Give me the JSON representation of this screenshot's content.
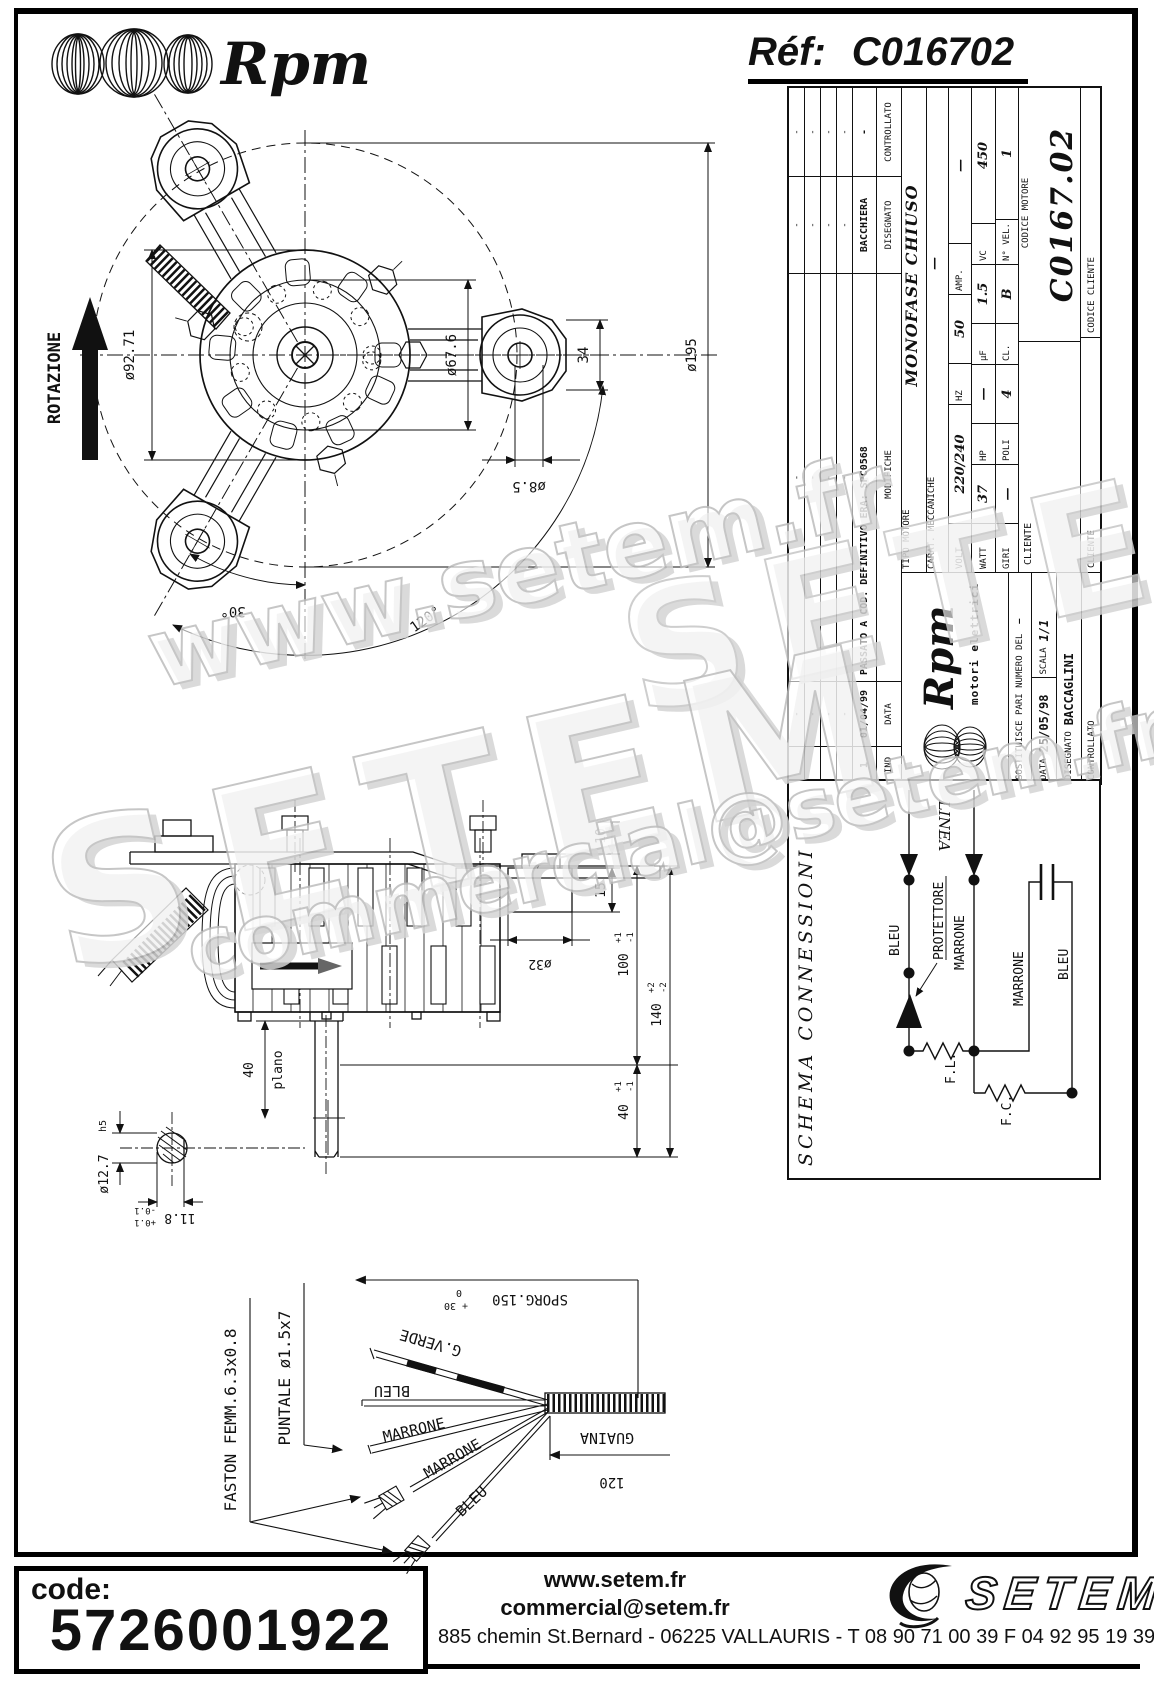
{
  "header": {
    "brand": "Rpm",
    "ref_label": "Réf:",
    "ref_value": "C016702"
  },
  "front_view": {
    "rotazione": "ROTAZIONE",
    "dia_core": "ø92.71",
    "dia_spigot": "ø67.6",
    "plate_width": "34",
    "dia_bolt_circle": "ø195",
    "dia_hole": "ø8.5",
    "angle_small": "30°",
    "angle_arms": "120°"
  },
  "side_view": {
    "d10": "10",
    "d15": "15",
    "d32": "ø32",
    "d100": "100",
    "d100_tp": "+1",
    "d100_tm": "-1",
    "d140": "140",
    "d140_tp": "+2",
    "d140_tm": "-2",
    "d40r": "40",
    "d40r_tp": "+1",
    "d40r_tm": "-1",
    "d40": "40",
    "plano": "plano",
    "d127": "ø12.7",
    "h5": "h5",
    "d118": "11.8",
    "d118_tp": "+0.1",
    "d118_tm": "-0.1"
  },
  "cable": {
    "faston": "FASTON FEMM.6.3x0.8",
    "puntale": "PUNTALE ø1.5x7",
    "sporg": "SPORG.150",
    "sporg_tp": "+ 30",
    "sporg_t0": "0",
    "guaina": "GUAINA",
    "d120": "120",
    "g_verde": "G.VERDE",
    "bleu1": "BLEU",
    "marrone1": "MARRONE",
    "marrone2": "MARRONE",
    "bleu2": "BLEU"
  },
  "schema": {
    "title": "SCHEMA CONNESSIONI",
    "linea": "LINEA",
    "bleu": "BLEU",
    "marrone": "MARRONE",
    "protettore": "PROTETTORE",
    "fl": "F.L.",
    "fc": "F.C.",
    "marrone2": "MARRONE",
    "bleu2": "BLEU"
  },
  "titleblock": {
    "dash": "-",
    "rev_header": {
      "ind": "IND",
      "data": "DATA",
      "modifiche": "MODIFICHE",
      "disegnato": "DISEGNATO",
      "controllato": "CONTROLLATO"
    },
    "rev_row": {
      "ind": "1",
      "data": "01/04/99",
      "modifiche": "PASSATO A COD. DEFINITIVO ERA: SPC0568",
      "disegnato": "BACCHIERA",
      "controllato": "-"
    },
    "brand": "Rpm",
    "brand_sub": "motori elettrici",
    "sostituisce": "SOSTITUISCE PARI NUMERO DEL",
    "sostituisce_val": "—",
    "data_label": "DATA",
    "data_val": "25/05/98",
    "scala_label": "SCALA",
    "scala_val": "1/1",
    "disegnato_label": "DISEGNATO",
    "disegnato_val": "BACCAGLINI",
    "controllato_label": "CONTROLLATO",
    "tipo_label": "TIPO MOTORE",
    "tipo_val": "MONOFASE CHIUSO",
    "carat_label": "CARAT. MECCANICHE",
    "carat_val": "—",
    "specs": [
      {
        "l": "VOLT",
        "v": "220/240"
      },
      {
        "l": "HZ",
        "v": "50"
      },
      {
        "l": "AMP.",
        "v": "—"
      },
      {
        "l": "WATT",
        "v": "37"
      },
      {
        "l": "HP",
        "v": "—"
      },
      {
        "l": "µF",
        "v": "1.5"
      },
      {
        "l": "VC",
        "v": "450"
      },
      {
        "l": "GIRI",
        "v": "—"
      },
      {
        "l": "POLI",
        "v": "4"
      },
      {
        "l": "CL.",
        "v": "B"
      },
      {
        "l": "N° VEL.",
        "v": "1"
      }
    ],
    "codice_motore_label": "CODICE MOTORE",
    "codice_motore_val": "C0167.02",
    "cliente_label": "CLIENTE",
    "cliente2_label": "CLIENTE",
    "codice_cliente_label": "CODICE CLIENTE"
  },
  "watermarks": {
    "wm1": "www.setem.fr",
    "wm2": "SETEM",
    "wm3": "commercial@setem.fr",
    "wm4": "SETEM"
  },
  "footer": {
    "code_label": "code:",
    "code_value": "5726001922",
    "site": "www.setem.fr",
    "email": "commercial@setem.fr",
    "address": "885 chemin St.Bernard  -  06225 VALLAURIS  -  T 08 90 71 00 39   F 04 92 95 19 39",
    "brand": "SETEM"
  }
}
